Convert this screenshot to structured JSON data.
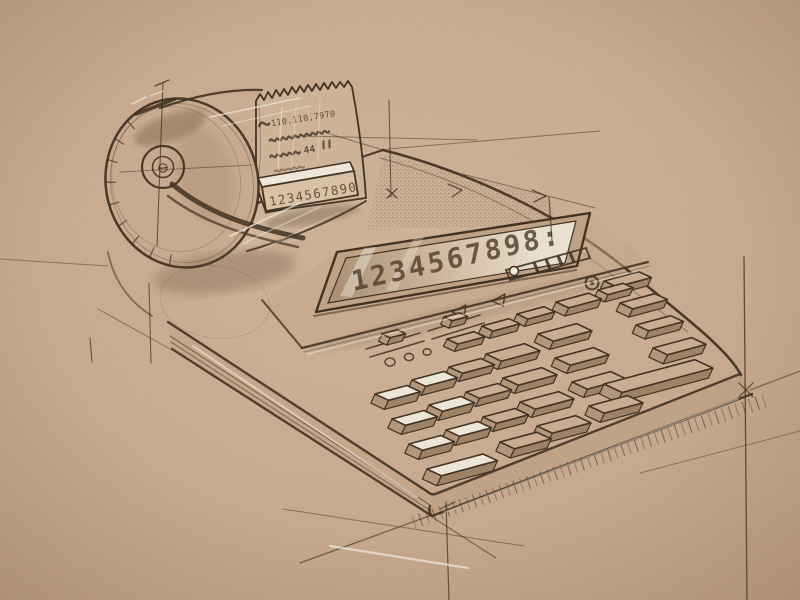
{
  "meta": {
    "title": "printing-calculator-concept-sketch",
    "medium": "ink-and-gouache-line-drawing-on-toned-paper"
  },
  "palette": {
    "paper": "#c9ab8f",
    "paper_light": "#d3b99f",
    "paper_dark": "#bda081",
    "ink": "#3a2a1b",
    "ink_soft": "#6b543c",
    "gouache_white": "#f4eee1",
    "key_top": "#cbae92",
    "key_white": "#f1ebdd",
    "key_side": "#b2967a",
    "key_front": "#9c8063",
    "display_glass_dark": "#a98f73",
    "display_glass_light": "#ece5d4",
    "shade": "#503a26"
  },
  "display": {
    "digits": "1234567898:"
  },
  "tape": {
    "printed_line": "110.110,7970",
    "printed_amount": "44",
    "tear_bar_digits": "1234567890"
  },
  "sketch": {
    "axes": {
      "b": [
        0.966,
        -0.259
      ],
      "a": [
        0.906,
        0.423
      ],
      "e": [
        -0.42,
        0.91
      ]
    },
    "keys": [
      [
        447,
        339,
        28,
        12,
        8,
        0
      ],
      [
        482,
        326,
        28,
        12,
        8,
        0
      ],
      [
        517,
        314,
        28,
        12,
        8,
        0
      ],
      [
        556,
        302,
        34,
        14,
        9,
        0
      ],
      [
        598,
        290,
        26,
        11,
        8,
        0
      ],
      [
        604,
        281,
        36,
        14,
        9,
        0
      ],
      [
        620,
        303,
        36,
        14,
        9,
        0
      ],
      [
        636,
        325,
        36,
        14,
        9,
        0
      ],
      [
        653,
        348,
        40,
        16,
        10,
        0
      ],
      [
        486,
        354,
        40,
        17,
        9,
        0
      ],
      [
        503,
        378,
        40,
        17,
        9,
        0
      ],
      [
        520,
        402,
        40,
        17,
        9,
        0
      ],
      [
        537,
        426,
        40,
        17,
        10,
        0
      ],
      [
        538,
        334,
        40,
        17,
        9,
        0
      ],
      [
        555,
        358,
        40,
        17,
        9,
        0
      ],
      [
        572,
        382,
        40,
        17,
        9,
        0
      ],
      [
        589,
        406,
        40,
        17,
        10,
        0
      ],
      [
        449,
        367,
        33,
        15,
        9,
        0
      ],
      [
        466,
        392,
        33,
        15,
        9,
        0
      ],
      [
        483,
        417,
        33,
        15,
        9,
        0
      ],
      [
        500,
        442,
        38,
        16,
        10,
        0
      ],
      [
        375,
        394,
        33,
        15,
        10,
        1
      ],
      [
        412,
        380,
        33,
        15,
        10,
        1
      ],
      [
        392,
        419,
        33,
        15,
        10,
        1
      ],
      [
        429,
        405,
        33,
        15,
        10,
        1
      ],
      [
        409,
        444,
        33,
        15,
        10,
        1
      ],
      [
        446,
        430,
        33,
        15,
        10,
        1
      ],
      [
        427,
        469,
        58,
        16,
        11,
        1
      ],
      [
        604,
        384,
        94,
        20,
        11,
        0
      ],
      [
        382,
        334,
        16,
        9,
        8,
        0
      ],
      [
        444,
        317,
        16,
        9,
        8,
        0
      ]
    ],
    "construction_lines": [
      [
        163,
        83,
        157,
        246,
        1.1,
        0.75
      ],
      [
        120,
        172,
        252,
        165,
        1.0,
        0.5
      ],
      [
        389,
        100,
        391,
        197,
        1.1,
        0.7
      ],
      [
        303,
        136,
        477,
        140,
        1.0,
        0.5
      ],
      [
        388,
        149,
        600,
        131,
        1.0,
        0.5
      ],
      [
        462,
        174,
        595,
        208,
        1.0,
        0.55
      ],
      [
        549,
        197,
        552,
        241,
        1.2,
        0.7
      ],
      [
        744,
        257,
        747,
        600,
        1.3,
        0.8
      ],
      [
        750,
        390,
        800,
        371,
        1.2,
        0.6
      ],
      [
        640,
        473,
        800,
        431,
        1.0,
        0.45
      ],
      [
        90,
        338,
        92,
        362,
        1.2,
        0.7
      ],
      [
        149,
        283,
        151,
        363,
        1.1,
        0.7
      ],
      [
        0,
        259,
        108,
        266,
        1.0,
        0.45
      ],
      [
        98,
        309,
        172,
        350,
        1.0,
        0.5
      ],
      [
        283,
        509,
        524,
        546,
        1.0,
        0.5
      ],
      [
        300,
        563,
        432,
        515,
        1.2,
        0.65
      ],
      [
        432,
        517,
        496,
        558,
        1.1,
        0.6
      ],
      [
        446,
        502,
        449,
        600,
        1.2,
        0.75
      ],
      [
        330,
        134,
        383,
        150,
        1.0,
        0.5
      ]
    ],
    "tick_marks": [
      [
        387,
        189,
        397,
        198,
        1.3,
        0.8
      ],
      [
        397,
        189,
        387,
        198,
        1.3,
        0.8
      ],
      [
        448,
        184,
        462,
        190,
        1.3,
        0.8
      ],
      [
        462,
        190,
        452,
        197,
        1.3,
        0.8
      ],
      [
        532,
        190,
        546,
        196,
        1.3,
        0.8
      ],
      [
        546,
        196,
        534,
        202,
        1.3,
        0.8
      ],
      [
        155,
        86,
        169,
        80,
        1.3,
        0.8
      ],
      [
        739,
        383,
        753,
        397,
        1.3,
        0.7
      ],
      [
        753,
        383,
        739,
        397,
        1.3,
        0.7
      ],
      [
        440,
        509,
        455,
        502,
        1.3,
        0.7
      ]
    ],
    "highlight_strokes": [
      [
        330,
        546,
        468,
        568,
        2.2,
        0.75
      ],
      [
        193,
        346,
        417,
        497,
        1.8,
        0.6
      ],
      [
        445,
        512,
        738,
        399,
        1.6,
        0.45
      ],
      [
        308,
        354,
        638,
        271,
        1.5,
        0.5
      ],
      [
        210,
        117,
        300,
        98,
        1.6,
        0.7
      ],
      [
        222,
        126,
        310,
        106,
        1.2,
        0.5
      ],
      [
        282,
        108,
        278,
        168,
        1.5,
        0.5
      ],
      [
        296,
        105,
        292,
        166,
        1.2,
        0.4
      ],
      [
        320,
        100,
        318,
        160,
        1.2,
        0.35
      ],
      [
        230,
        236,
        300,
        203,
        1.8,
        0.7
      ],
      [
        244,
        243,
        320,
        207,
        1.4,
        0.5
      ],
      [
        260,
        250,
        340,
        212,
        1.2,
        0.4
      ],
      [
        132,
        104,
        146,
        97,
        1.6,
        0.7
      ],
      [
        150,
        96,
        163,
        91,
        1.4,
        0.6
      ]
    ],
    "shadow_hatch": {
      "from": [
        412,
        516
      ],
      "to": [
        762,
        395
      ],
      "count": 52,
      "dx": 4,
      "dy": 12
    },
    "ladder_hatch": {
      "rail1": [
        210,
        137,
        241,
        192
      ],
      "rail2": [
        227,
        129,
        254,
        184
      ],
      "rungs": 8
    },
    "rim_ticks": {
      "cx": 182,
      "cy": 183,
      "rx": 76,
      "ry": 85,
      "rot": -14,
      "from": 115,
      "to": 240,
      "count": 9
    },
    "indicator_dots": [
      [
        390,
        362,
        5
      ],
      [
        409,
        357,
        4.5
      ],
      [
        427,
        352,
        4
      ]
    ],
    "triangles": [
      [
        452,
        312,
        466,
        305,
        464,
        317
      ],
      [
        492,
        301,
        505,
        294,
        503,
        306
      ]
    ],
    "mode_slider_ticks": [
      0.35,
      0.5,
      0.65,
      0.8
    ]
  }
}
